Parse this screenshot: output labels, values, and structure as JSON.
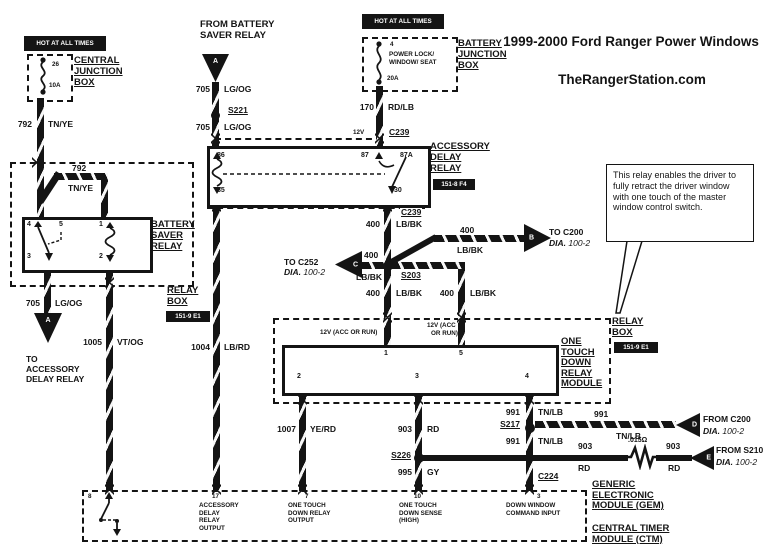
{
  "header": {
    "title": "1999-2000 Ford Ranger Power Windows",
    "site": "TheRangerStation.com"
  },
  "banners": {
    "hot": "HOT AT ALL TIMES"
  },
  "cjb": {
    "name": [
      "CENTRAL",
      "JUNCTION",
      "BOX"
    ],
    "fuse_id": "26",
    "fuse_amp": "10A"
  },
  "bjb": {
    "name": [
      "BATTERY",
      "JUNCTION",
      "BOX"
    ],
    "fuse_id": "4",
    "fuse_desc": [
      "POWER LOCK/",
      "WINDOW/ SEAT"
    ],
    "fuse_amp": "20A"
  },
  "wires": {
    "w792": {
      "num": "792",
      "color": "TN/YE"
    },
    "w705": {
      "num": "705",
      "color": "LG/OG"
    },
    "w170": {
      "num": "170",
      "color": "RD/LB"
    },
    "w400": {
      "num": "400",
      "color": "LB/BK"
    },
    "w1004": {
      "num": "1004",
      "color": "LB/RD"
    },
    "w1005": {
      "num": "1005",
      "color": "VT/OG"
    },
    "w1007": {
      "num": "1007",
      "color": "YE/RD"
    },
    "w903": {
      "num": "903",
      "color": "RD"
    },
    "w995": {
      "num": "995",
      "color": "GY"
    },
    "w991": {
      "num": "991",
      "color": "TN/LB"
    }
  },
  "splices": {
    "s221": "S221",
    "s203": "S203",
    "s217": "S217",
    "s226": "S226"
  },
  "connectors": {
    "c239": "C239",
    "c224": "C224",
    "v12": "12V"
  },
  "relay_box": {
    "name": [
      "RELAY",
      "BOX"
    ],
    "grid": "151-9 E1"
  },
  "bsr": {
    "name": [
      "BATTERY",
      "SAVER",
      "RELAY"
    ],
    "pins": {
      "p4": "4",
      "p5": "5",
      "p1": "1",
      "p3": "3",
      "p2": "2"
    }
  },
  "adr": {
    "name": [
      "ACCESSORY",
      "DELAY",
      "RELAY"
    ],
    "grid": "151-8 F4",
    "pins": {
      "p86": "86",
      "p85": "85",
      "p87": "87",
      "p87a": "87A",
      "p30": "30"
    }
  },
  "otdm": {
    "name": [
      "ONE",
      "TOUCH",
      "DOWN",
      "RELAY",
      "MODULE"
    ],
    "pins": {
      "p1": "1",
      "p5": "5",
      "p2": "2",
      "p3": "3",
      "p4": "4"
    },
    "acc1": "12V (ACC OR RUN)",
    "acc2": [
      "12V (ACC",
      "OR RUN)"
    ]
  },
  "gem": {
    "pins": [
      {
        "num": "8",
        "label": []
      },
      {
        "num": "17",
        "label": [
          "ACCESSORY",
          "DELAY",
          "RELAY",
          "OUTPUT"
        ]
      },
      {
        "num": "7",
        "label": [
          "ONE TOUCH",
          "DOWN RELAY",
          "OUTPUT"
        ]
      },
      {
        "num": "10",
        "label": [
          "ONE TOUCH",
          "DOWN SENSE",
          "(HIGH)"
        ]
      },
      {
        "num": "3",
        "label": [
          "DOWN WINDOW",
          "COMMAND INPUT"
        ]
      }
    ],
    "name1": [
      "GENERIC",
      "ELECTRONIC",
      "MODULE (GEM)"
    ],
    "name2": [
      "CENTRAL TIMER",
      "MODULE (CTM)"
    ]
  },
  "offpage": {
    "a_top": {
      "letter": "A",
      "text": [
        "FROM BATTERY",
        "SAVER RELAY"
      ]
    },
    "a_bot": {
      "letter": "A",
      "text": [
        "TO",
        "ACCESSORY",
        "DELAY RELAY"
      ]
    },
    "b": {
      "letter": "B",
      "text": "TO C200",
      "dia": "DIA.",
      "ref": "100-2"
    },
    "c": {
      "letter": "C",
      "text": "TO C252",
      "dia": "DIA.",
      "ref": "100-2"
    },
    "d": {
      "letter": "D",
      "text": "FROM C200",
      "dia": "DIA.",
      "ref": "100-2"
    },
    "e": {
      "letter": "E",
      "text": "FROM S210",
      "dia": "DIA.",
      "ref": "100-2"
    }
  },
  "resistor": {
    "value": ".015Ω"
  },
  "note": {
    "text": "This relay enables the driver to fully retract the driver window with one touch of the master window control switch."
  }
}
